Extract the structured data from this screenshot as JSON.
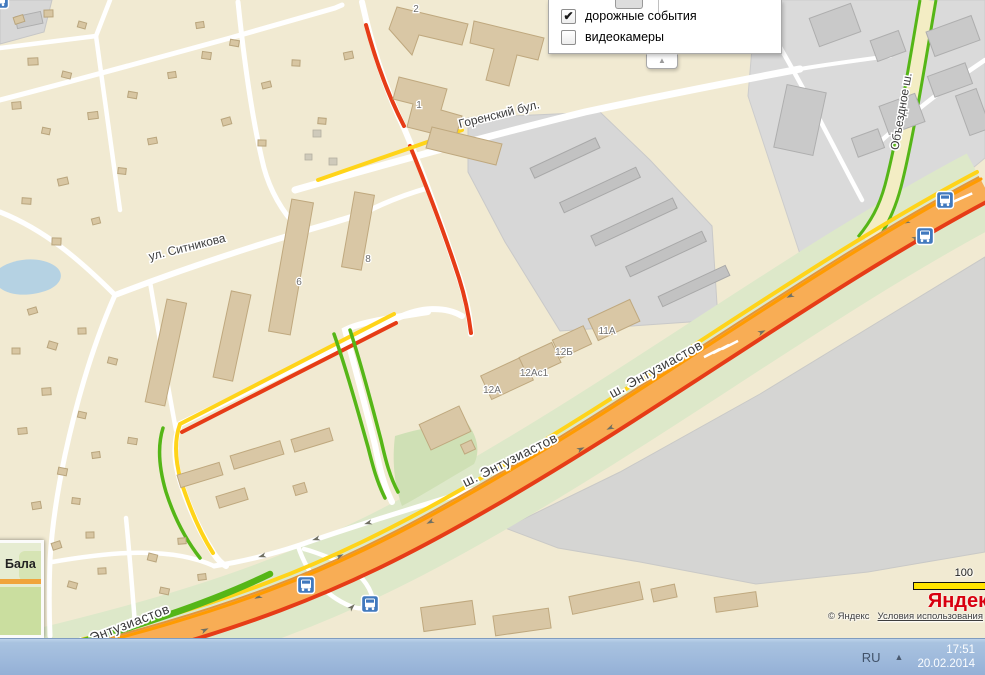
{
  "popup": {
    "items": [
      {
        "label": "дорожные события",
        "glyph": "✔",
        "checked": "true"
      },
      {
        "label": "видеокамеры",
        "glyph": "",
        "checked": "false"
      }
    ],
    "collapse_glyph": "▲"
  },
  "map": {
    "labels": {
      "gorensky": "Горенский бул.",
      "sitnikova": "ул. Ситникова",
      "entuziastov": "ш. Энтузиастов",
      "obezdnoe": "Объездное ш.",
      "minimap_city": "Бала"
    },
    "buildings": {
      "b2": "2",
      "b1": "1",
      "b6": "6",
      "b8": "8",
      "b11a": "11А",
      "b12b": "12Б",
      "b12as1": "12Ас1",
      "b12a": "12А"
    },
    "traffic_legend": {
      "free": "#55b617",
      "slow": "#ffd419",
      "heavy": "#ff9b00",
      "jam": "#e63c17"
    }
  },
  "attribution": {
    "scale_value": "100",
    "logo": "Яндекс",
    "copyright": "© Яндекс",
    "terms_link": "Условия использования"
  },
  "taskbar": {
    "language": "RU",
    "tray_arrow": "▲",
    "time": "17:51",
    "date": "20.02.2014"
  }
}
